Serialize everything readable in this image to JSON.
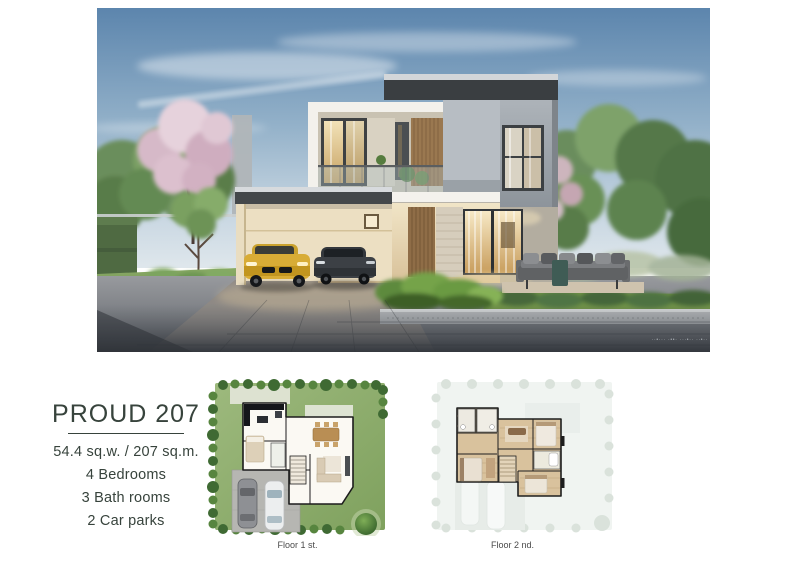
{
  "listing": {
    "title": "PROUD 207",
    "area": "54.4 sq.w. / 207 sq.m.",
    "specs": {
      "bedrooms": "4 Bedrooms",
      "bathrooms": "3 Bath rooms",
      "carparks": "2 Car parks"
    }
  },
  "floor_plans": {
    "plan1_caption": "Floor 1 st.",
    "plan2_caption": "Floor 2 nd."
  },
  "hero": {
    "watermark": "··•··· ·••· ···•·· ··•··"
  },
  "colors": {
    "text_dark": "#37433c",
    "sky_top": "#5c85ad",
    "blossom_pink": "#dcc0ce",
    "lawn_green": "#7d9f5b",
    "car_yellow": "#d3a432",
    "driveway_dark": "#4b4f55"
  }
}
